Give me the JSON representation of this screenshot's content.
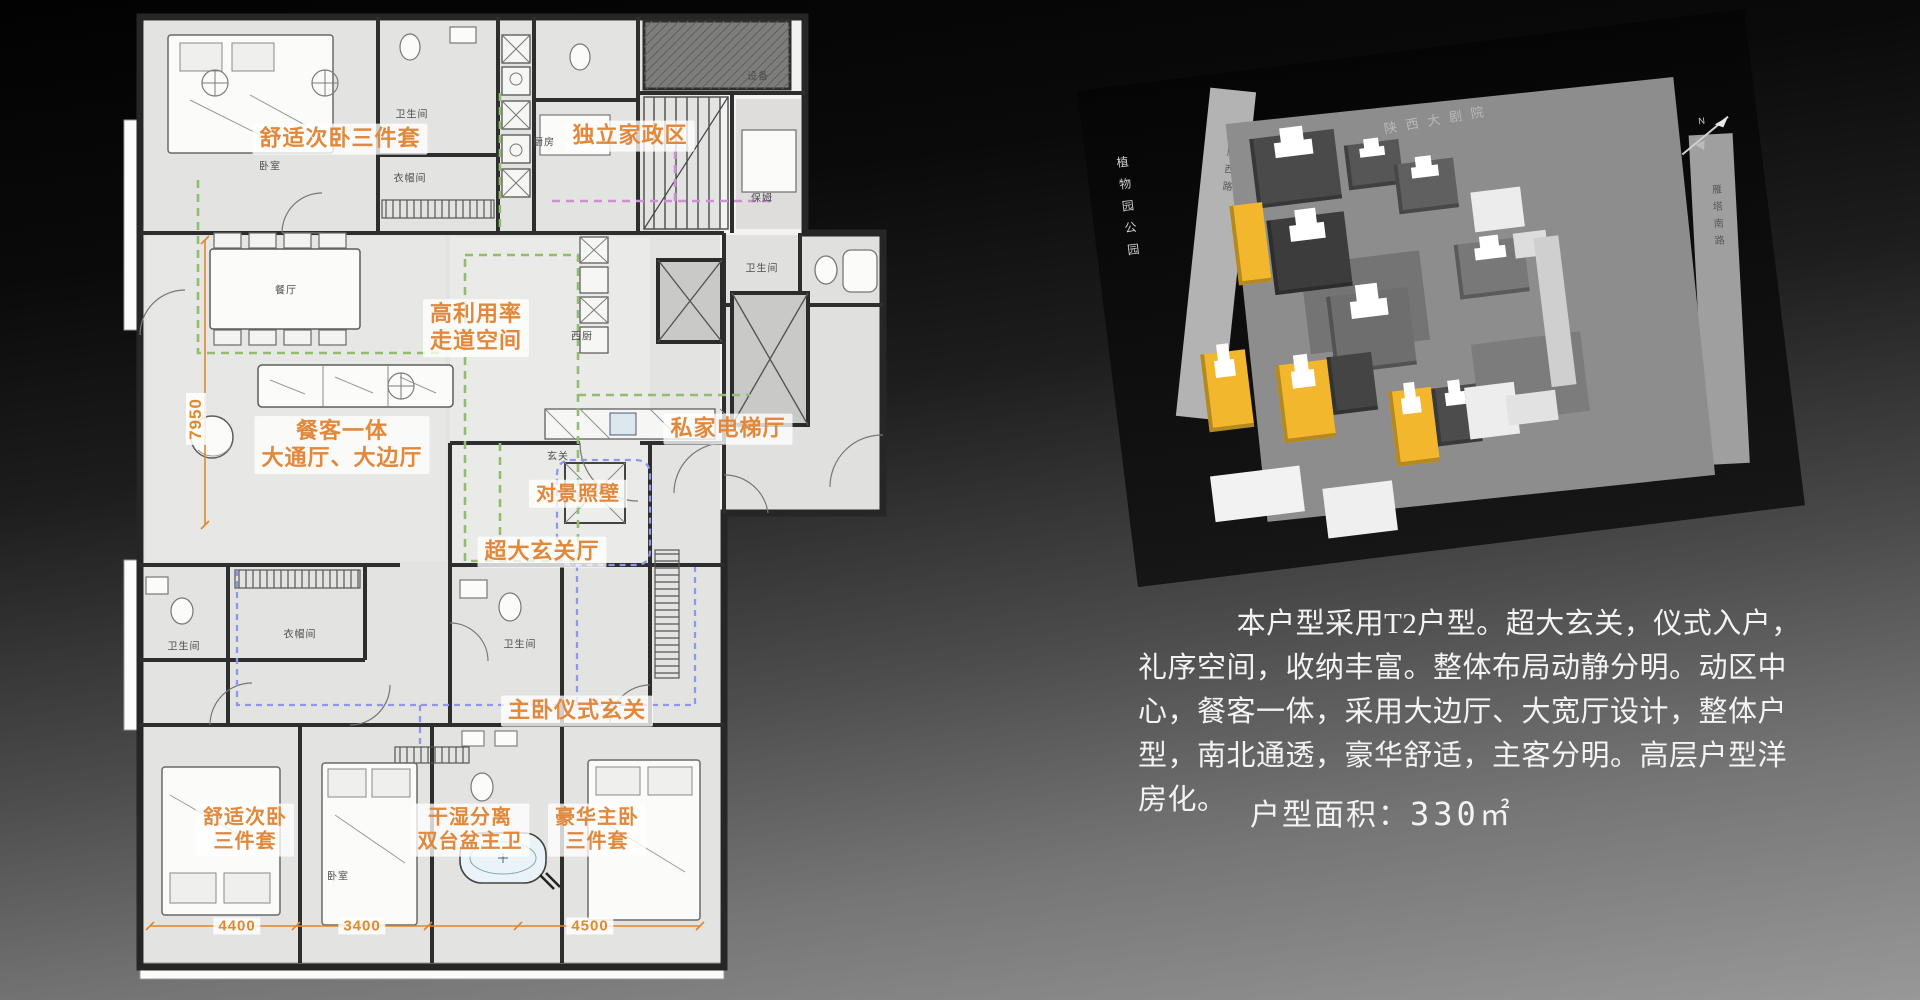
{
  "floor_plan": {
    "accent_color": "#e2883a",
    "annotations": [
      {
        "text": "舒适次卧三件套"
      },
      {
        "text": "独立家政区"
      },
      {
        "text": "高利用率\n走道空间"
      },
      {
        "text": "餐客一体\n大通厅、大边厅"
      },
      {
        "text": "私家电梯厅"
      },
      {
        "text": "对景照壁"
      },
      {
        "text": "超大玄关厅"
      },
      {
        "text": "主卧仪式玄关"
      },
      {
        "text": "舒适次卧\n三件套"
      },
      {
        "text": "干湿分离\n双台盆主卫"
      },
      {
        "text": "豪华主卧\n三件套"
      }
    ],
    "dimensions": {
      "left_vertical": "7950",
      "bottom": [
        "4400",
        "3400",
        "4500"
      ]
    },
    "room_labels": [
      "卧室",
      "卫生间",
      "衣帽间",
      "厨房",
      "设备",
      "保姆",
      "餐厅",
      "西厨",
      "玄关",
      "卫生间",
      "衣帽间",
      "卫生间",
      "卧室",
      "卫生间"
    ]
  },
  "site_plan": {
    "highlight_color": "#f2b72c",
    "labels": {
      "top_road": "陕西大剧院",
      "left_park": "植物园公园",
      "left_road": "慈恩西路",
      "right_road": "雁塔南路",
      "north": "N"
    }
  },
  "description": {
    "paragraph": "本户型采用T2户型。超大玄关，仪式入户，礼序空间，收纳丰富。整体布局动静分明。动区中心，餐客一体，采用大边厅、大宽厅设计，整体户型，南北通透，豪华舒适，主客分明。高层户型洋房化。",
    "area_label": "户型面积：",
    "area_value": "330",
    "area_unit": "㎡"
  }
}
